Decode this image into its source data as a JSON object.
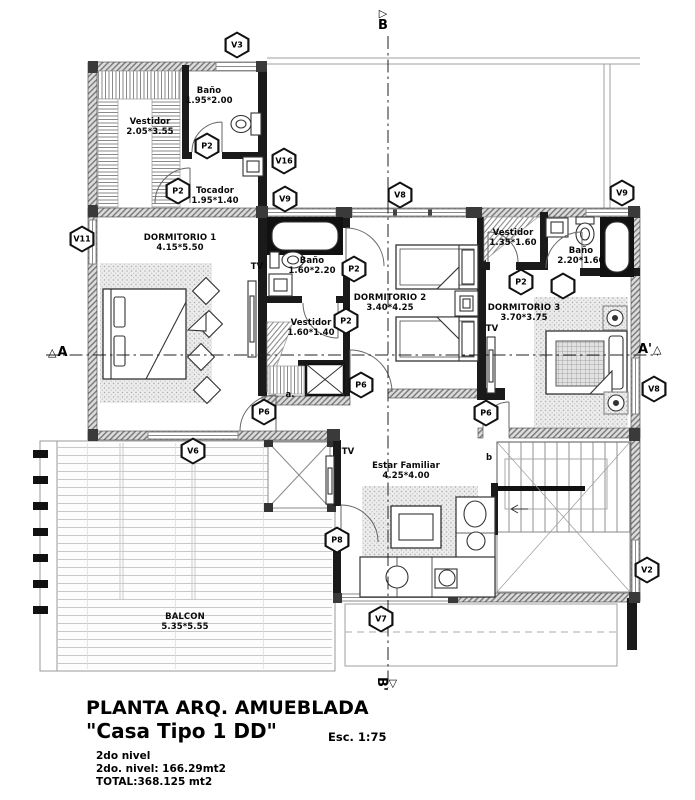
{
  "title_block": {
    "title": "PLANTA ARQ. AMUEBLADA",
    "subtitle": "\"Casa Tipo 1 DD\"",
    "scale": "Esc. 1:75",
    "notes": [
      "2do nivel",
      "2do. nivel: 166.29mt2",
      "TOTAL:368.125 mt2"
    ]
  },
  "plan": {
    "rooms": [
      {
        "name": "Vestidor",
        "dims": "2.05*3.55",
        "x": 150,
        "y": 127
      },
      {
        "name": "Baño",
        "dims": "1.95*2.00",
        "x": 209,
        "y": 96
      },
      {
        "name": "Tocador",
        "dims": "1.95*1.40",
        "x": 215,
        "y": 196
      },
      {
        "name": "DORMITORIO 1",
        "dims": "4.15*5.50",
        "x": 180,
        "y": 243
      },
      {
        "name": "Baño",
        "dims": "1.60*2.20",
        "x": 312,
        "y": 266
      },
      {
        "name": "Vestidor",
        "dims": "1.60*1.40",
        "x": 311,
        "y": 328
      },
      {
        "name": "DORMITORIO 2",
        "dims": "3.40*4.25",
        "x": 390,
        "y": 303
      },
      {
        "name": "Vestidor",
        "dims": "1.35*1.60",
        "x": 513,
        "y": 238
      },
      {
        "name": "Baño",
        "dims": "2.20*1.60",
        "x": 581,
        "y": 256
      },
      {
        "name": "DORMITORIO 3",
        "dims": "3.70*3.75",
        "x": 524,
        "y": 313
      },
      {
        "name": "Estar Familiar",
        "dims": "4.25*4.00",
        "x": 406,
        "y": 471
      },
      {
        "name": "BALCON",
        "dims": "5.35*5.55",
        "x": 185,
        "y": 622
      }
    ],
    "markers": [
      {
        "label": "V3",
        "x": 237,
        "y": 45
      },
      {
        "label": "P2",
        "x": 207,
        "y": 146
      },
      {
        "label": "P2",
        "x": 178,
        "y": 191
      },
      {
        "label": "V16",
        "x": 284,
        "y": 161
      },
      {
        "label": "V9",
        "x": 285,
        "y": 199
      },
      {
        "label": "V8",
        "x": 400,
        "y": 195
      },
      {
        "label": "V9",
        "x": 622,
        "y": 193
      },
      {
        "label": "V11",
        "x": 82,
        "y": 239
      },
      {
        "label": "P2",
        "x": 354,
        "y": 269
      },
      {
        "label": "P2",
        "x": 346,
        "y": 321
      },
      {
        "label": "P2",
        "x": 521,
        "y": 282
      },
      {
        "label": "",
        "x": 563,
        "y": 286
      },
      {
        "label": "P6",
        "x": 361,
        "y": 385
      },
      {
        "label": "P6",
        "x": 264,
        "y": 412
      },
      {
        "label": "P6",
        "x": 486,
        "y": 413
      },
      {
        "label": "P8",
        "x": 337,
        "y": 540
      },
      {
        "label": "V6",
        "x": 193,
        "y": 451
      },
      {
        "label": "V7",
        "x": 381,
        "y": 619
      },
      {
        "label": "V2",
        "x": 647,
        "y": 570
      },
      {
        "label": "V8",
        "x": 654,
        "y": 389
      }
    ],
    "misc_labels": [
      {
        "text": "TV",
        "x": 257,
        "y": 267
      },
      {
        "text": "TV",
        "x": 492,
        "y": 329
      },
      {
        "text": "TV",
        "x": 348,
        "y": 452
      },
      {
        "text": "a.",
        "x": 290,
        "y": 395
      },
      {
        "text": "b",
        "x": 489,
        "y": 458
      }
    ],
    "section": {
      "top": "B",
      "bottom": "B'",
      "left": "A",
      "right": "A'"
    }
  }
}
